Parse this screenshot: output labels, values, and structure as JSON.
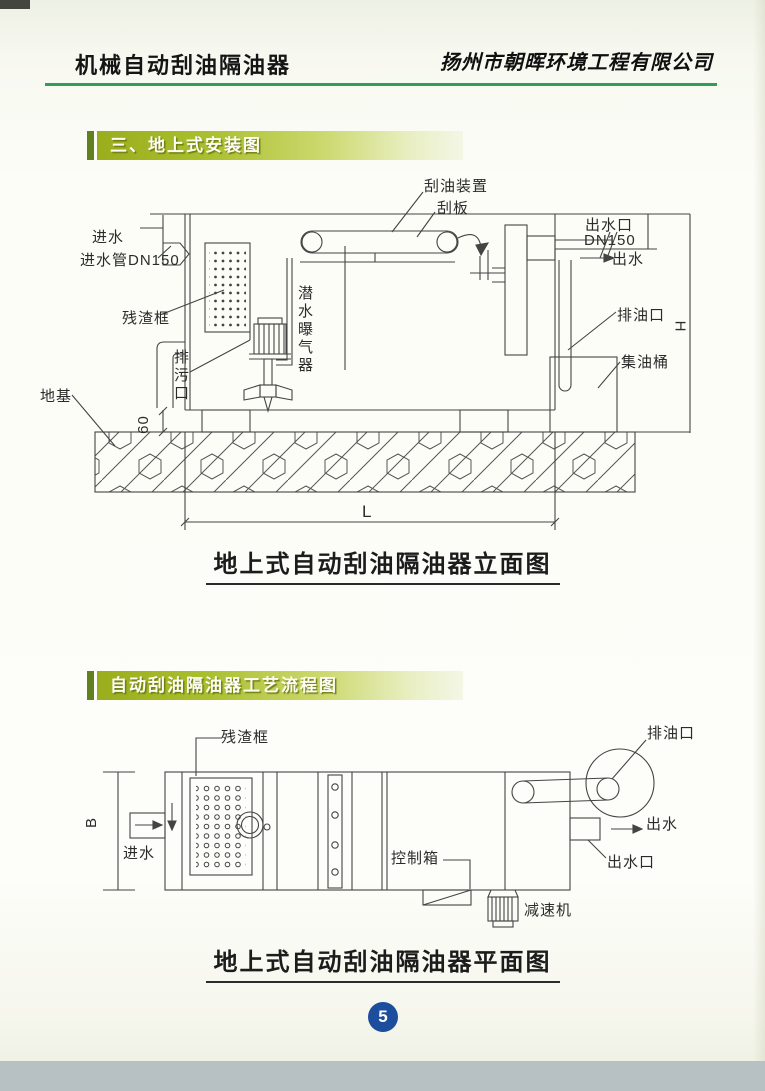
{
  "header": {
    "title": "机械自动刮油隔油器",
    "company": "扬州市朝晖环境工程有限公司"
  },
  "section1": {
    "banner": "三、地上式安装图",
    "caption": "地上式自动刮油隔油器立面图",
    "labels": {
      "scraper_device": "刮油装置",
      "scraper_blade": "刮板",
      "outlet_port": "出水口",
      "outlet_dn": "DN150",
      "outlet_flow": "出水",
      "inlet_flow": "进水",
      "inlet_pipe": "进水管DN150",
      "residue_frame": "残渣框",
      "drain_port": "排污口",
      "aerator": "潜水曝气器",
      "foundation": "地基",
      "oil_drain": "排油口",
      "oil_barrel": "集油桶",
      "dim_h": "H",
      "dim_l": "L",
      "dim_60": "60"
    }
  },
  "section2": {
    "banner": "自动刮油隔油器工艺流程图",
    "caption": "地上式自动刮油隔油器平面图",
    "labels": {
      "residue_frame": "残渣框",
      "oil_drain": "排油口",
      "outlet_flow": "出水",
      "outlet_port": "出水口",
      "inlet_flow": "进水",
      "control_box": "控制箱",
      "reducer": "减速机",
      "dim_b": "B"
    }
  },
  "footer": {
    "page_number": "5"
  },
  "colors": {
    "banner_green": "#99ad1d",
    "header_rule": "#2f9f58",
    "page_circle_blue": "#1d4e9e",
    "line": "#444444"
  }
}
